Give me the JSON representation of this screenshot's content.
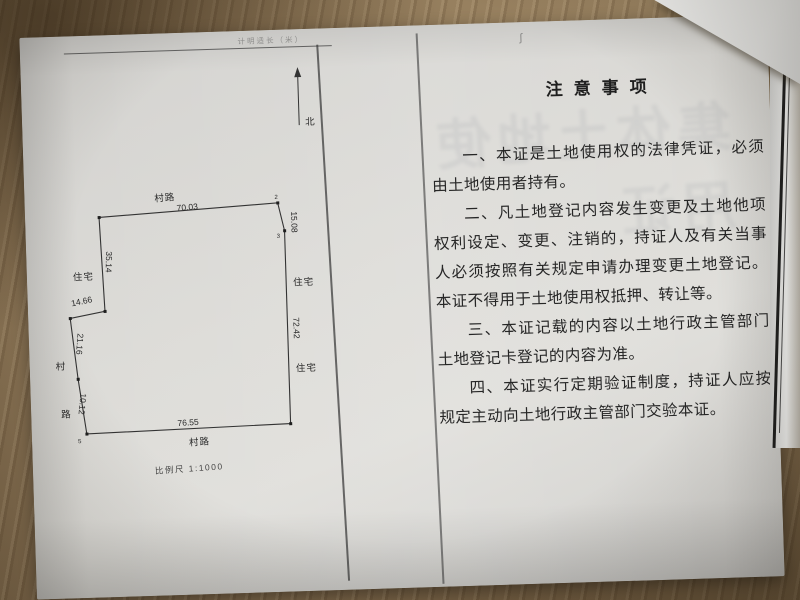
{
  "photo": {
    "wood_color": "#8a7355",
    "paper_color": "#d7d6d2",
    "stray_mark": "ʃ"
  },
  "parcel_map": {
    "faint_caption": "计明适长（米）",
    "north_label": "北",
    "scale_label": "比例尺 1:1000",
    "roads": {
      "top": "村路",
      "bottom": "村路",
      "left_top": "村",
      "left_bottom": "路"
    },
    "neighbors": {
      "left": "住宅",
      "right_upper": "住宅",
      "right_lower": "住宅"
    },
    "edge_lengths": {
      "top": "70.03",
      "right_upper": "15.08",
      "right_lower": "72.42",
      "left_upper": "35.14",
      "jog": "14.66",
      "left_mid": "21.16",
      "left_lower": "10.12",
      "bottom": "76.55"
    },
    "vertex_numbers": {
      "p2": "2",
      "p3": "3",
      "p7": "5"
    }
  },
  "notice_page": {
    "ghost_text": "集体土地使用证",
    "title": "注意事项",
    "paragraphs": [
      "一、本证是土地使用权的法律凭证，必须由土地使用者持有。",
      "二、凡土地登记内容发生变更及土地他项权利设定、变更、注销的，持证人及有关当事人必须按照有关规定申请办理变更土地登记。本证不得用于土地使用权抵押、转让等。",
      "三、本证记载的内容以土地行政主管部门土地登记卡登记的内容为准。",
      "四、本证实行定期验证制度，持证人应按规定主动向土地行政主管部门交验本证。"
    ]
  }
}
